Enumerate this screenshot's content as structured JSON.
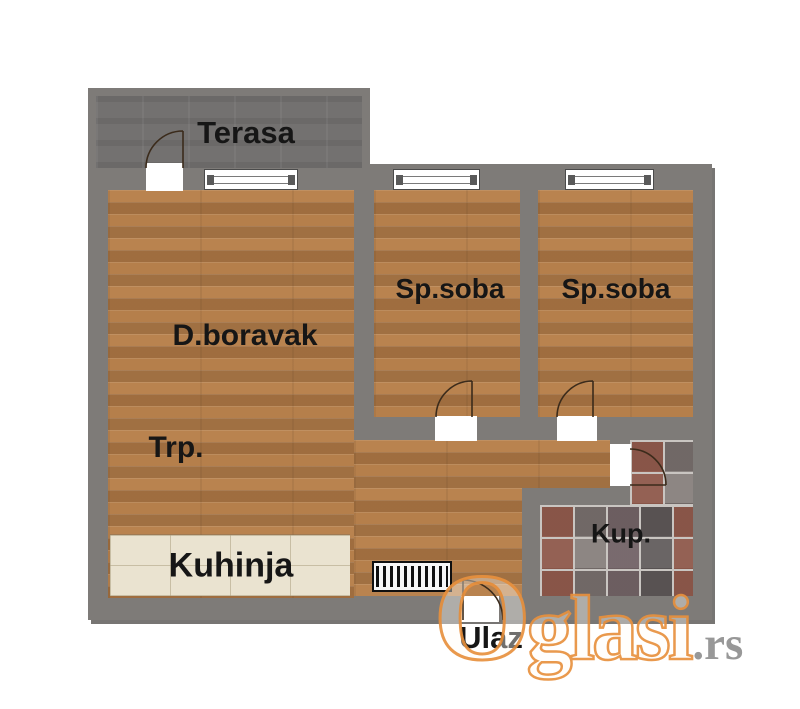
{
  "type": "apartment-floor-plan",
  "rooms": [
    {
      "name": "terrace",
      "label": "Terasa"
    },
    {
      "name": "living-room",
      "label": "D.boravak"
    },
    {
      "name": "bedroom-1",
      "label": "Sp.soba"
    },
    {
      "name": "bedroom-2",
      "label": "Sp.soba"
    },
    {
      "name": "dining-area",
      "label": "Trp."
    },
    {
      "name": "kitchen",
      "label": "Kuhinja"
    },
    {
      "name": "bathroom",
      "label": "Kup."
    },
    {
      "name": "entrance",
      "label": "Ulaz"
    }
  ],
  "watermark": {
    "brand": "Oglasi",
    "tld": ".rs"
  },
  "colors": {
    "wall": "#7e7b78",
    "wood": "#b9834f",
    "kitchen_tile": "#eae3d0",
    "bath_tile_base": "#8d8683",
    "terrace_floor": "#737170",
    "watermark_orange": "#e8913e",
    "watermark_gray": "#909090",
    "label": "#161616"
  }
}
